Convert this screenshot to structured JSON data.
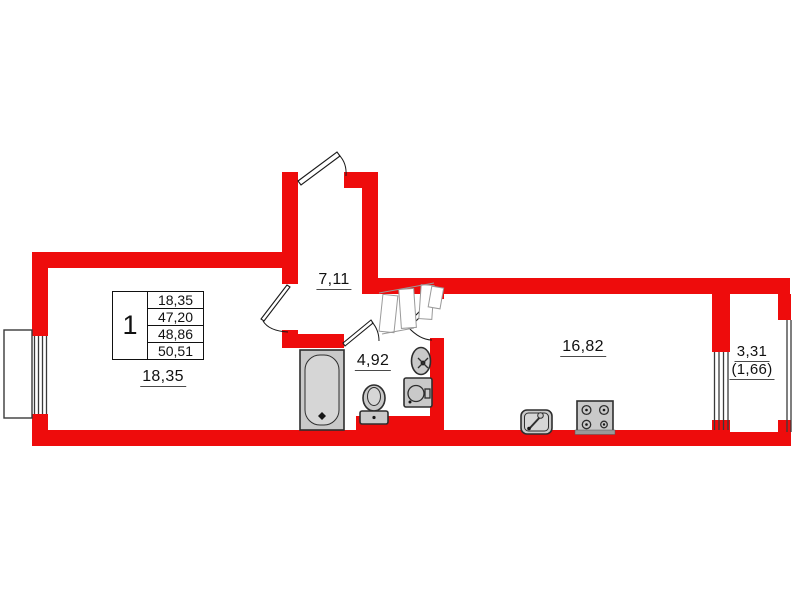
{
  "plan": {
    "info_table": {
      "apartment_number": "1",
      "rows": [
        "18,35",
        "47,20",
        "48,86",
        "50,51"
      ]
    },
    "rooms": [
      {
        "id": "living-room",
        "area_label": "18,35"
      },
      {
        "id": "hallway",
        "area_label": "7,11"
      },
      {
        "id": "bathroom",
        "area_label": "4,92"
      },
      {
        "id": "kitchen",
        "area_label": "16,82"
      },
      {
        "id": "balcony",
        "area_label": "3,31",
        "area_label_secondary": "(1,66)"
      }
    ],
    "fixtures": [
      "bathtub",
      "toilet",
      "bathroom-sink",
      "washing-machine",
      "kitchen-sink",
      "stove",
      "wardrobe"
    ],
    "colors": {
      "wall": "#ee0c0c",
      "fixture_fill": "#c9c9c9",
      "line": "#1a1a1a"
    }
  }
}
